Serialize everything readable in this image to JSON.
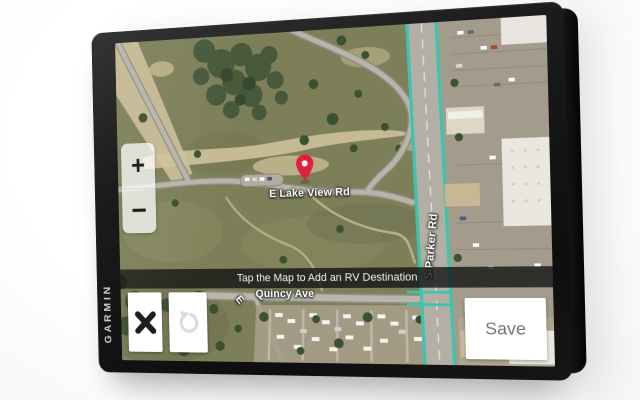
{
  "device": {
    "brand": "GARMIN"
  },
  "screen": {
    "banner_text": "Tap the Map to Add an RV Destination",
    "controls": {
      "zoom_in": "+",
      "zoom_out": "−",
      "save": "Save"
    },
    "icons": {
      "close": "✕",
      "undo": "↺",
      "pin": "map-pin"
    },
    "map": {
      "streets": {
        "lake_view": "E Lake View Rd",
        "quincy": "Quincy Ave",
        "quincy_prefix": "E",
        "parker": "S Parker Rd"
      },
      "colors": {
        "route_highlight": "#3cc4b0",
        "pin": "#e0203f",
        "field": "#7c7f58"
      }
    }
  }
}
